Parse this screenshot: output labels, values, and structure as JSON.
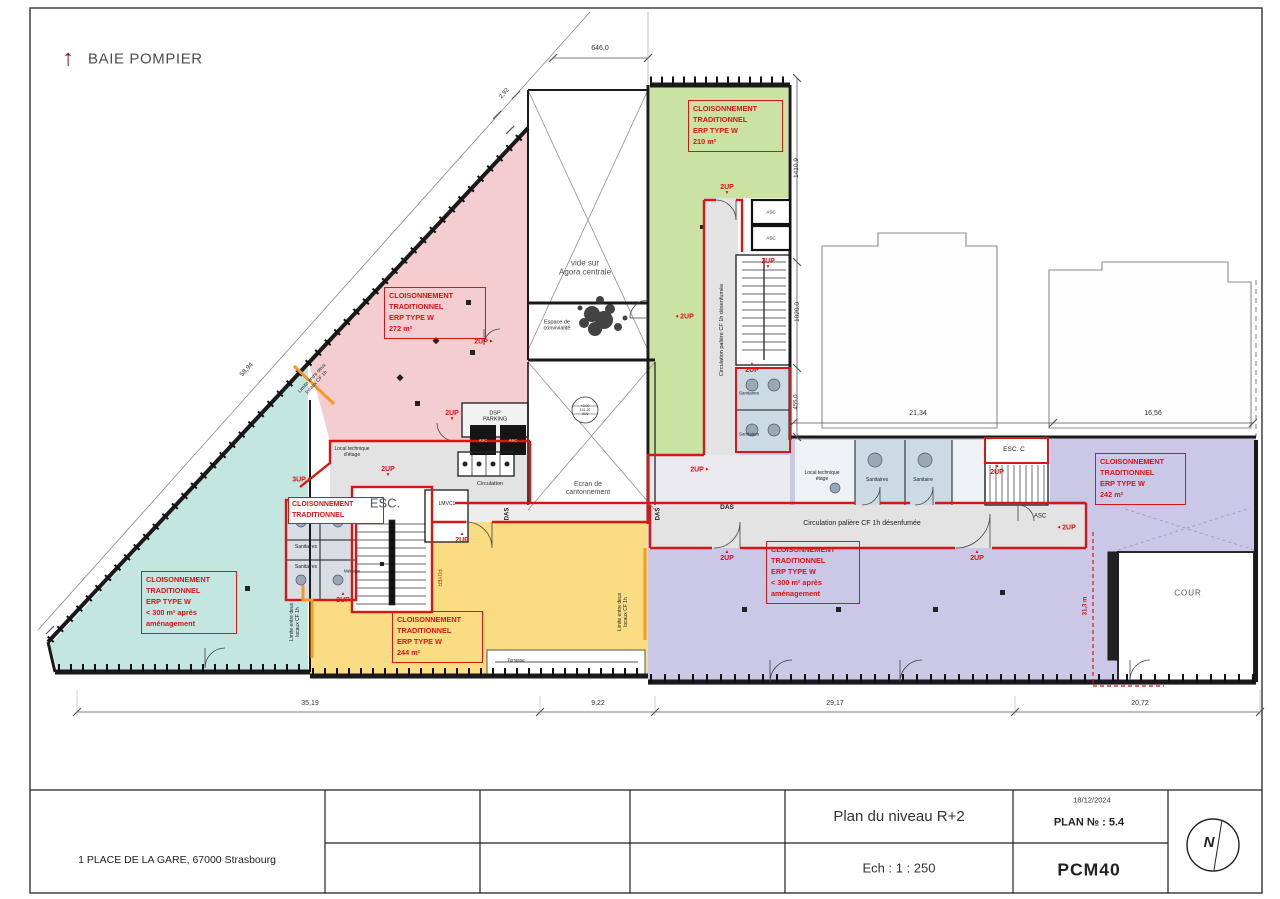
{
  "page": {
    "baie_pompier": "BAIE POMPIER"
  },
  "colors": {
    "red": "#d81616",
    "orange": "#f59a23",
    "zone_pink": "#f3cdd0",
    "zone_teal": "#c4e6e0",
    "zone_green": "#cbe3a2",
    "zone_yellow": "#fadc82",
    "zone_purple": "#cbc7e6",
    "corridor_gray": "#e3e3e3",
    "room_blue": "#ccdbe3"
  },
  "zones": {
    "pink": "CLOISONNEMENT\nTRADITIONNEL\nERP TYPE W\n272 m²",
    "teal": "CLOISONNEMENT\nTRADITIONNEL\nERP TYPE W\n< 300 m² après\naménagement",
    "green": "CLOISONNEMENT\nTRADITIONNEL\nERP TYPE W\n210 m²",
    "yellow": "CLOISONNEMENT\nTRADITIONNEL\nERP TYPE W\n244 m²",
    "purple_left": "CLOISONNEMENT\nTRADITIONNEL\nERP TYPE W\n< 300 m² après\naménagement",
    "purple_right": "CLOISONNEMENT\nTRADITIONNEL\nERP TYPE W\n242 m²",
    "core": "CLOISONNEMENT\nTRADITIONNEL"
  },
  "labels": {
    "up2": "2UP",
    "up3": "3UP",
    "das": "DAS",
    "asc": "ASC",
    "esc": "ESC.",
    "esc_c": "ESC. C",
    "lmvc": "LMVC1",
    "vide": "vide sur\nAgora centrale",
    "espace": "Espace de\nconvivialité",
    "ecran": "Ecran de\ncantonnement",
    "circulation": "Circulation",
    "circ_palier": "Circulation palière CF 1h désenfumée",
    "dsp": "DSP\nPARKING",
    "sanitaires": "Sanitaires",
    "sanitaire": "Sanitaire",
    "menage": "Ménage",
    "foyer": "FOYER",
    "local_tech": "Local technique\nd'étage",
    "local_tech2": "Local technique\nétage",
    "limite": "Limite entre deux\nlocaux CF 1h",
    "cour": "COUR",
    "terrasse": "Terrasse",
    "elev": "+0.00\n141.20\nIGN"
  },
  "glyphs": {
    "tri_up": "▲",
    "tri_down": "▼",
    "tri_left": "◄",
    "tri_right": "►",
    "north": "N",
    "arrow_up": "↑"
  },
  "dimensions": {
    "top": "646,0",
    "diag_small": "2,92",
    "diag_left": "58,94",
    "right_v1": "1410,9",
    "right_v2": "1020,0",
    "right_v3": "455,0",
    "mid_h1": "21,34",
    "mid_h2": "16,56",
    "bottom": [
      "35,19",
      "9,22",
      "29,17",
      "20,72"
    ],
    "red_v": "31,3 m"
  },
  "titleblock": {
    "address": "1 PLACE DE LA GARE, 67000 Strasbourg",
    "title": "Plan du niveau R+2",
    "scale": "Ech : 1 : 250",
    "date": "18/12/2024",
    "plan_no": "PLAN № : 5.4",
    "code": "PCM40"
  }
}
